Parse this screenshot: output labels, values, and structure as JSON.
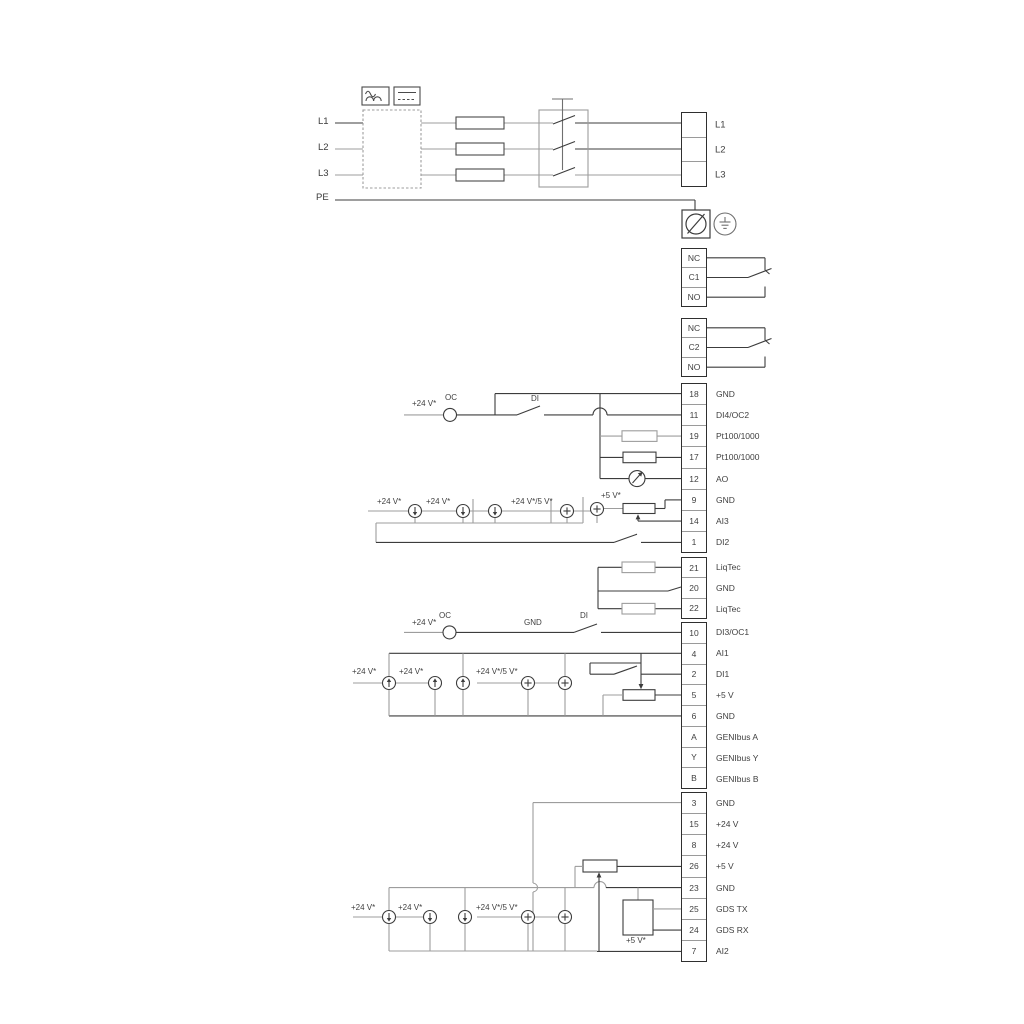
{
  "diagram": {
    "title": "Wiring diagram",
    "left_labels": [
      "L1",
      "L2",
      "L3",
      "PE"
    ],
    "power_terminals": [
      "L1",
      "L2",
      "L3"
    ],
    "relay1": [
      "NC",
      "C1",
      "NO"
    ],
    "relay2": [
      "NC",
      "C2",
      "NO"
    ],
    "io_group1": [
      {
        "id": "18",
        "label": "GND"
      },
      {
        "id": "11",
        "label": "DI4/OC2"
      },
      {
        "id": "19",
        "label": "Pt100/1000"
      },
      {
        "id": "17",
        "label": "Pt100/1000"
      },
      {
        "id": "12",
        "label": "AO"
      },
      {
        "id": "9",
        "label": "GND"
      },
      {
        "id": "14",
        "label": "AI3"
      },
      {
        "id": "1",
        "label": "DI2"
      }
    ],
    "liqtec_group": [
      {
        "id": "21",
        "label": "LiqTec"
      },
      {
        "id": "20",
        "label": "GND"
      },
      {
        "id": "22",
        "label": "LiqTec"
      }
    ],
    "io_group2": [
      {
        "id": "10",
        "label": "DI3/OC1"
      },
      {
        "id": "4",
        "label": "AI1"
      },
      {
        "id": "2",
        "label": "DI1"
      },
      {
        "id": "5",
        "label": "+5 V"
      },
      {
        "id": "6",
        "label": "GND"
      },
      {
        "id": "A",
        "label": "GENIbus A"
      },
      {
        "id": "Y",
        "label": "GENIbus Y"
      },
      {
        "id": "B",
        "label": "GENIbus B"
      }
    ],
    "io_group3": [
      {
        "id": "3",
        "label": "GND"
      },
      {
        "id": "15",
        "label": "+24 V"
      },
      {
        "id": "8",
        "label": "+24 V"
      },
      {
        "id": "26",
        "label": "+5 V"
      },
      {
        "id": "23",
        "label": "GND"
      },
      {
        "id": "25",
        "label": "GDS TX"
      },
      {
        "id": "24",
        "label": "GDS RX"
      },
      {
        "id": "7",
        "label": "AI2"
      }
    ],
    "annotations": {
      "v24": "+24 V*",
      "oc": "OC",
      "di": "DI",
      "gnd": "GND",
      "v24_v5": "+24 V*/5 V*",
      "v5": "+5 V*"
    },
    "colors": {
      "wire_dark": "#3c3c3c",
      "wire_gray": "#9d9d9d",
      "background": "#ffffff"
    }
  }
}
